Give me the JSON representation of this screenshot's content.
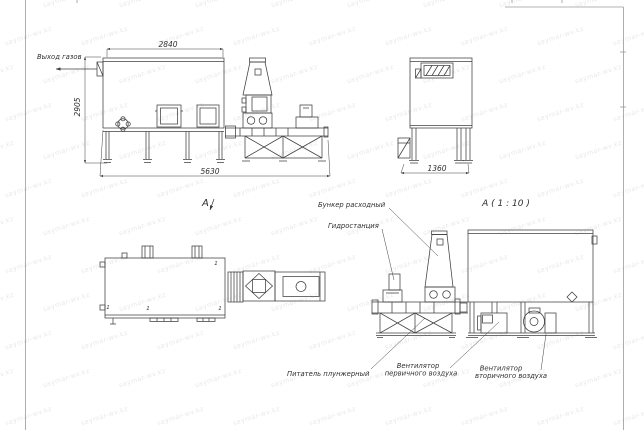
{
  "colors": {
    "line": "#3f3f3f",
    "label_text": "#2f2f2f",
    "background": "#ffffff",
    "frame": "#9a9a9a",
    "watermark": "rgba(110,110,110,0.16)"
  },
  "watermark": {
    "text": "saymar-wv.kz"
  },
  "views": {
    "side_view": {
      "gas_outlet_label": "Выход газов",
      "dim_width_top": "2840",
      "dim_height_left": "2905",
      "dim_length_bottom": "5630"
    },
    "end_view": {
      "dim_width_bottom": "1360"
    },
    "plan_view": {
      "label": "А",
      "position_mark": "1"
    },
    "detail_view": {
      "title": "А ( 1 : 10 )",
      "labels": {
        "hopper": "Бункер расходный",
        "hydraulic_station": "Гидростанция",
        "plunger_feeder": "Питатель плунжерный",
        "primary_fan_line1": "Вентилятор",
        "primary_fan_line2": "первичного воздуха",
        "secondary_fan_line1": "Вентилятор",
        "secondary_fan_line2": "вторичного воздуха"
      }
    }
  }
}
